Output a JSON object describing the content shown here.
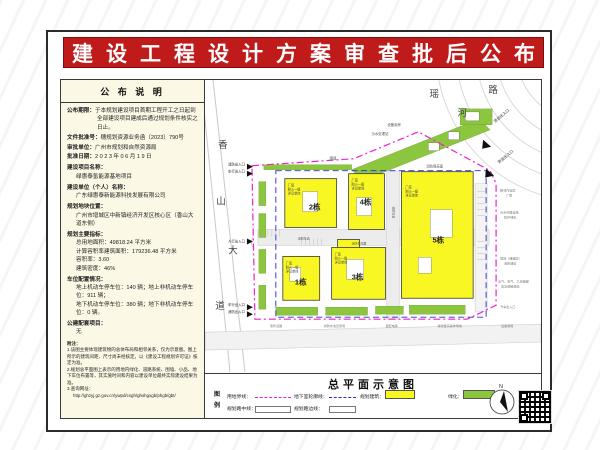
{
  "banner": {
    "title": "建设工程设计方案审查批后公布"
  },
  "left_panel": {
    "header": "公 布 说 明",
    "publish": [
      {
        "label": "公布期限：",
        "text": "于本规划建设项目首期工程开工之日起到全部建设项目建成后通过规划条件核实之日止。"
      },
      {
        "label": "文件批准号：",
        "text": "穗规划资源业务函〔2023〕790号"
      },
      {
        "label": "审批单位：",
        "text": "广州市规划和自然资源局"
      },
      {
        "label": "批准日期：",
        "text": "2023年06月19日"
      }
    ],
    "sections": [
      {
        "label": "建设项目名称：",
        "value": "绿惠泰氢能源基地项目"
      },
      {
        "label": "建设单位（个人）名称：",
        "value": "广东绿惠泰新能源科技发展有限公司"
      },
      {
        "label": "规划地块位置：",
        "value": "广州市增城区中新镇经济开发区核心区（香山大道东侧）"
      }
    ],
    "indicators": {
      "label": "规划主要指标：",
      "items": [
        "总用地面积：49818.24 平方米",
        "计算容积率建筑面积：179236.48 平方米",
        "容积率：3.60",
        "建筑密度：46%"
      ]
    },
    "parking": {
      "label": "车位配置情况：",
      "items": [
        "地上机动车停车位：140 辆；地上非机动车停车位：911 辆；",
        "地下机动车停车位：380 辆；地下非机动车停车位：0 辆。"
      ]
    },
    "public_facility": {
      "label": "公建配套项目：",
      "value": "无"
    },
    "notes": {
      "label": "附注：",
      "items": [
        "1.该图主要体现建筑物的总体布局和相邻关系，仅为示意图。图上所示的建筑间距、尺寸尚未经核定，以《建设工程规划许可证》核定为准。",
        "2.规划总平面图上表示的用地内绿化、道路系统、围墙、小品、地下车位布置等，其实施时间和内容以建设单位最终实际建设结果为准。",
        "3.查询网址："
      ],
      "url": "http://ghzyj.gz.gov.cn/ywpd/csgh/ghshgxgb/phgb/gbt/"
    }
  },
  "map": {
    "roads": [
      "瑶",
      "路",
      "河",
      "香",
      "山",
      "大",
      "道"
    ],
    "buildings": [
      {
        "label": "1栋",
        "n1": "厂房",
        "n2": "耐火一级",
        "n3": "详见单体"
      },
      {
        "label": "2栋",
        "n1": "厂房",
        "n2": "耐火一级",
        "n3": "详见单体"
      },
      {
        "label": "3栋",
        "n1": "厂房",
        "n2": "耐火一级",
        "n3": "详见单体"
      },
      {
        "label": "4栋",
        "n1": "厂房",
        "n2": "耐火一级",
        "n3": "详见单体"
      },
      {
        "label": "5栋",
        "n1": "厂房",
        "n2": "耐火一级",
        "n3": "详见单体"
      }
    ],
    "entrances": [
      "消防出入口",
      "车行出入口",
      "人行出入口",
      "车行出入口",
      "消防出入口",
      "货运出入口",
      "货运出入口"
    ],
    "labels": [
      "围墙",
      "设备用房",
      "污水处理站",
      "消防登高面",
      "消防车道",
      "消防登高面",
      "消防车道",
      "相邻作业区",
      "厂房",
      "污水处理设施",
      "防护绿化",
      "堆场（储罐区）",
      "消防通道",
      "氢气、氧气、乙炔储罐",
      "应急疏散通道",
      "汽车出入口",
      "现状道路",
      "消防水池及泵房",
      "变配电房",
      "消防登高操作场地",
      "设备用房"
    ]
  },
  "footer": {
    "title": "总平面示意图",
    "legend_col": [
      "图",
      "例"
    ],
    "row1": [
      "用地界线：",
      "地下室轮廓线：",
      "规划建筑：",
      "绿化："
    ],
    "row2": [
      "规划路中线：",
      "规划路边线："
    ],
    "north": "N"
  },
  "colors": {
    "banner_red": "#bf1b1b",
    "boundary_magenta": "#ef1fd0",
    "basement_blue": "#2a2ad0",
    "building_yellow": "#f8f623",
    "greenery": "#8cc63f",
    "panel_cream": "#fcf8e6"
  }
}
